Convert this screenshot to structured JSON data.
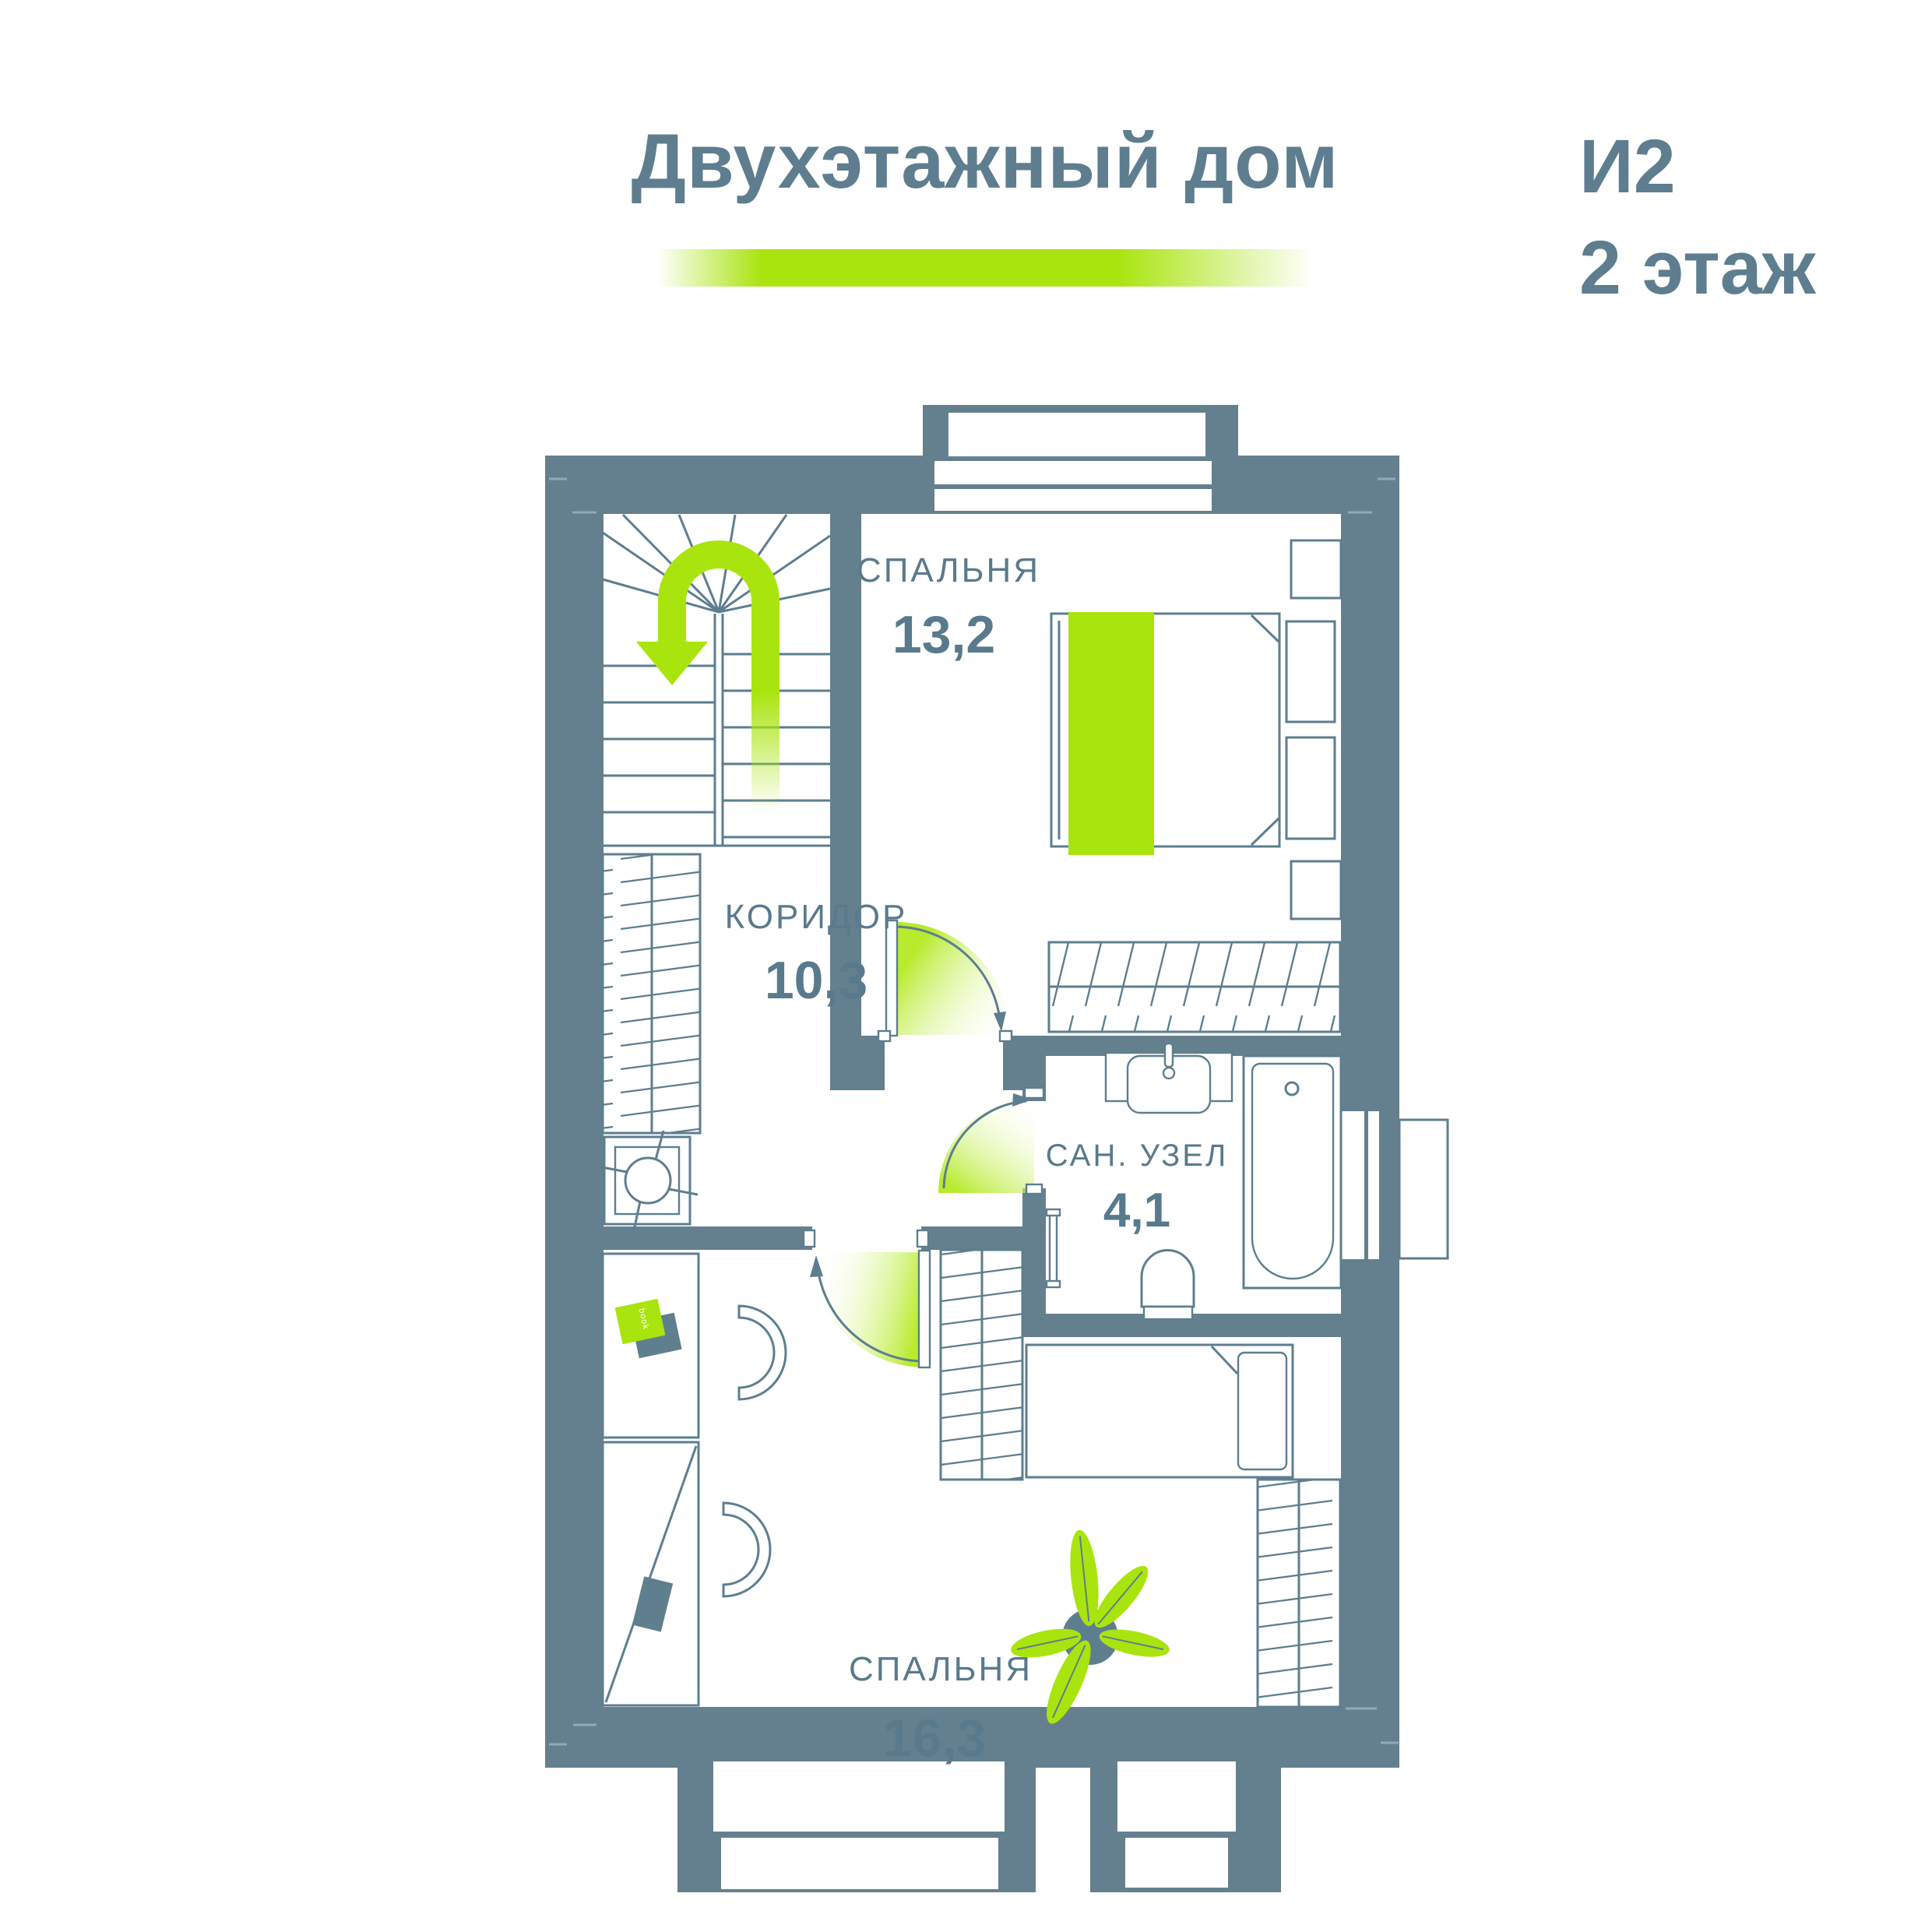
{
  "header": {
    "title": "Двухэтажный дом",
    "plan_code": "И2",
    "floor_label": "2 этаж"
  },
  "rooms": [
    {
      "name": "СПАЛЬНЯ",
      "area": "13,2"
    },
    {
      "name": "КОРИДОР",
      "area": "10,3"
    },
    {
      "name": "САН. УЗЕЛ",
      "area": "4,1"
    },
    {
      "name": "СПАЛЬНЯ",
      "area": "16,3"
    }
  ],
  "furniture": {
    "book_label": "book"
  },
  "colors": {
    "wall": "#64808F",
    "outline": "#5D7E8F",
    "text": "#597A8C",
    "accent_green": "#A9E40E",
    "background": "#FFFFFF"
  }
}
